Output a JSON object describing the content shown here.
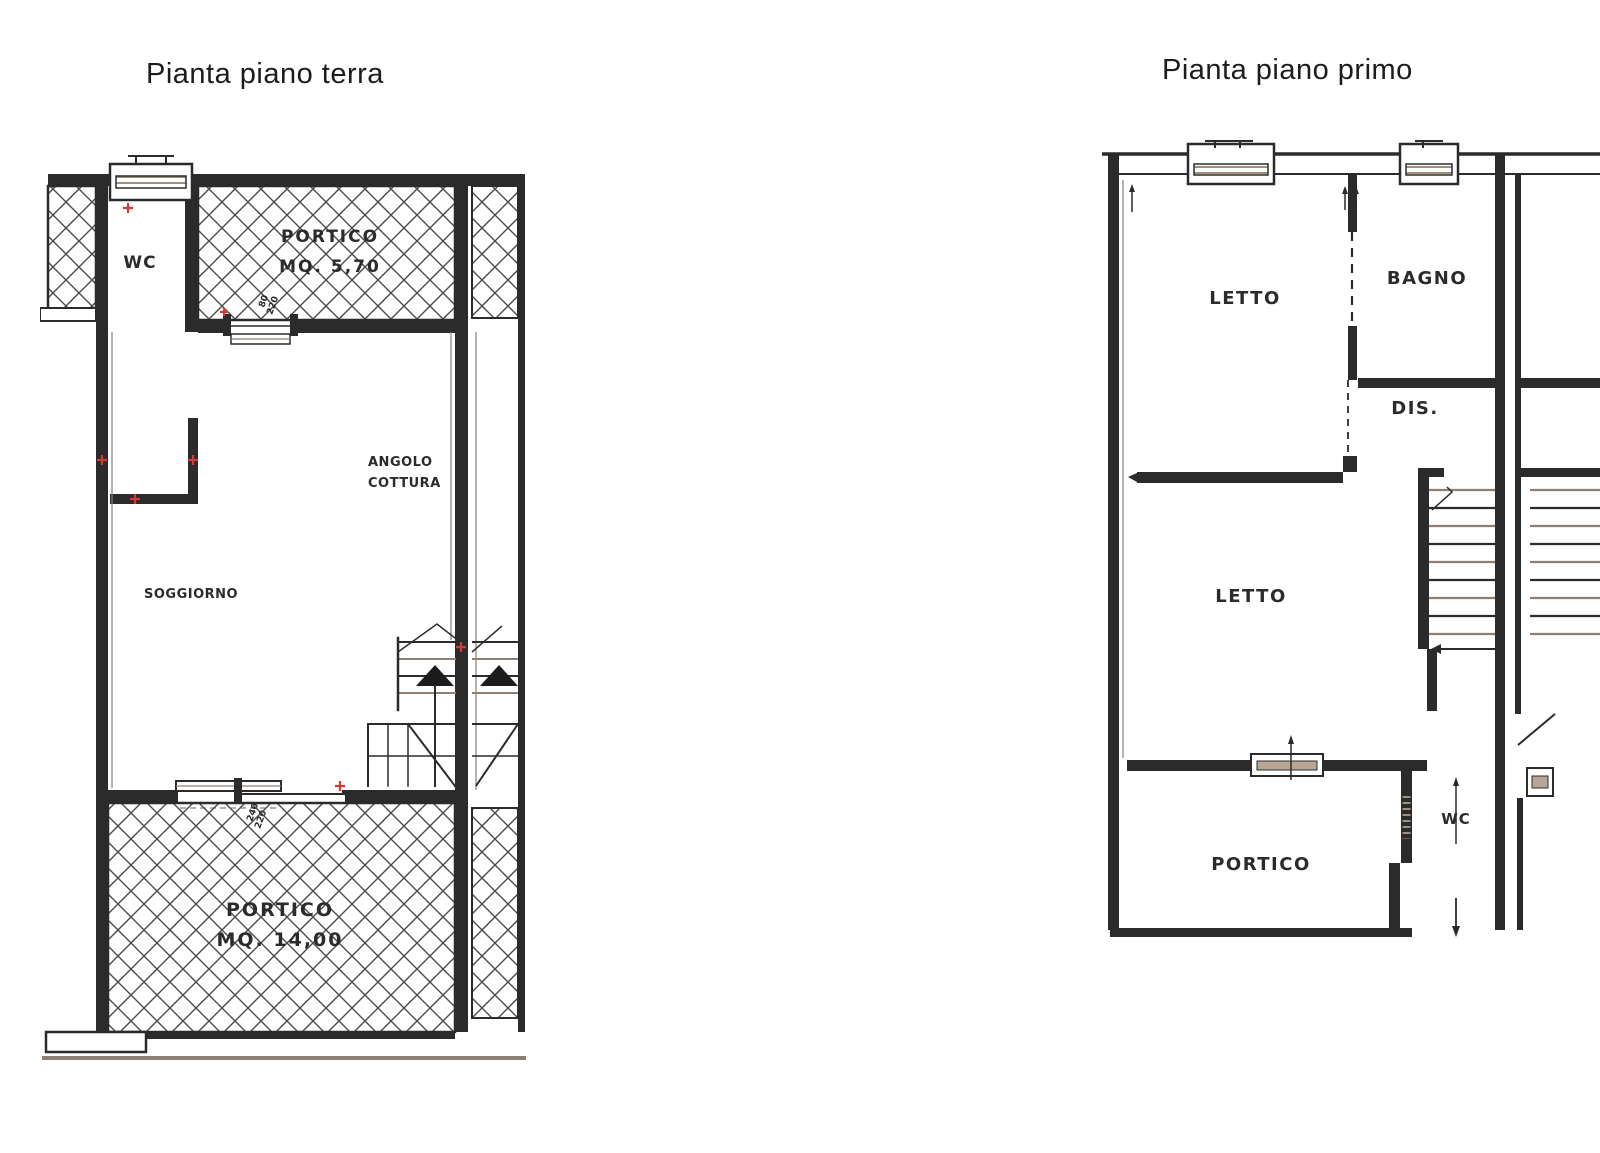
{
  "document": {
    "type": "scanned-floor-plan",
    "colors": {
      "ink": "#2b2b2b",
      "scan_gray": "#8d7f73",
      "marker_red": "#d43a35",
      "sill_tan": "#b7a695"
    }
  },
  "plans": [
    {
      "title": "Pianta piano terra",
      "labels": {
        "wc": "WC",
        "portico_top_name": "PORTICO",
        "portico_top_area": "MQ. 5,70",
        "angolo_line1": "ANGOLO",
        "angolo_line2": "COTTURA",
        "soggiorno": "SOGGIORNO",
        "portico_bottom_name": "PORTICO",
        "portico_bottom_area": "MQ. 14,00"
      },
      "dims": {
        "top_door": [
          "80",
          "220"
        ],
        "bottom_door": [
          "240",
          "220"
        ]
      }
    },
    {
      "title": "Pianta piano primo",
      "labels": {
        "letto_top": "LETTO",
        "bagno": "BAGNO",
        "dis": "DIS.",
        "letto_bottom": "LETTO",
        "wc": "WC",
        "portico": "PORTICO"
      }
    }
  ]
}
